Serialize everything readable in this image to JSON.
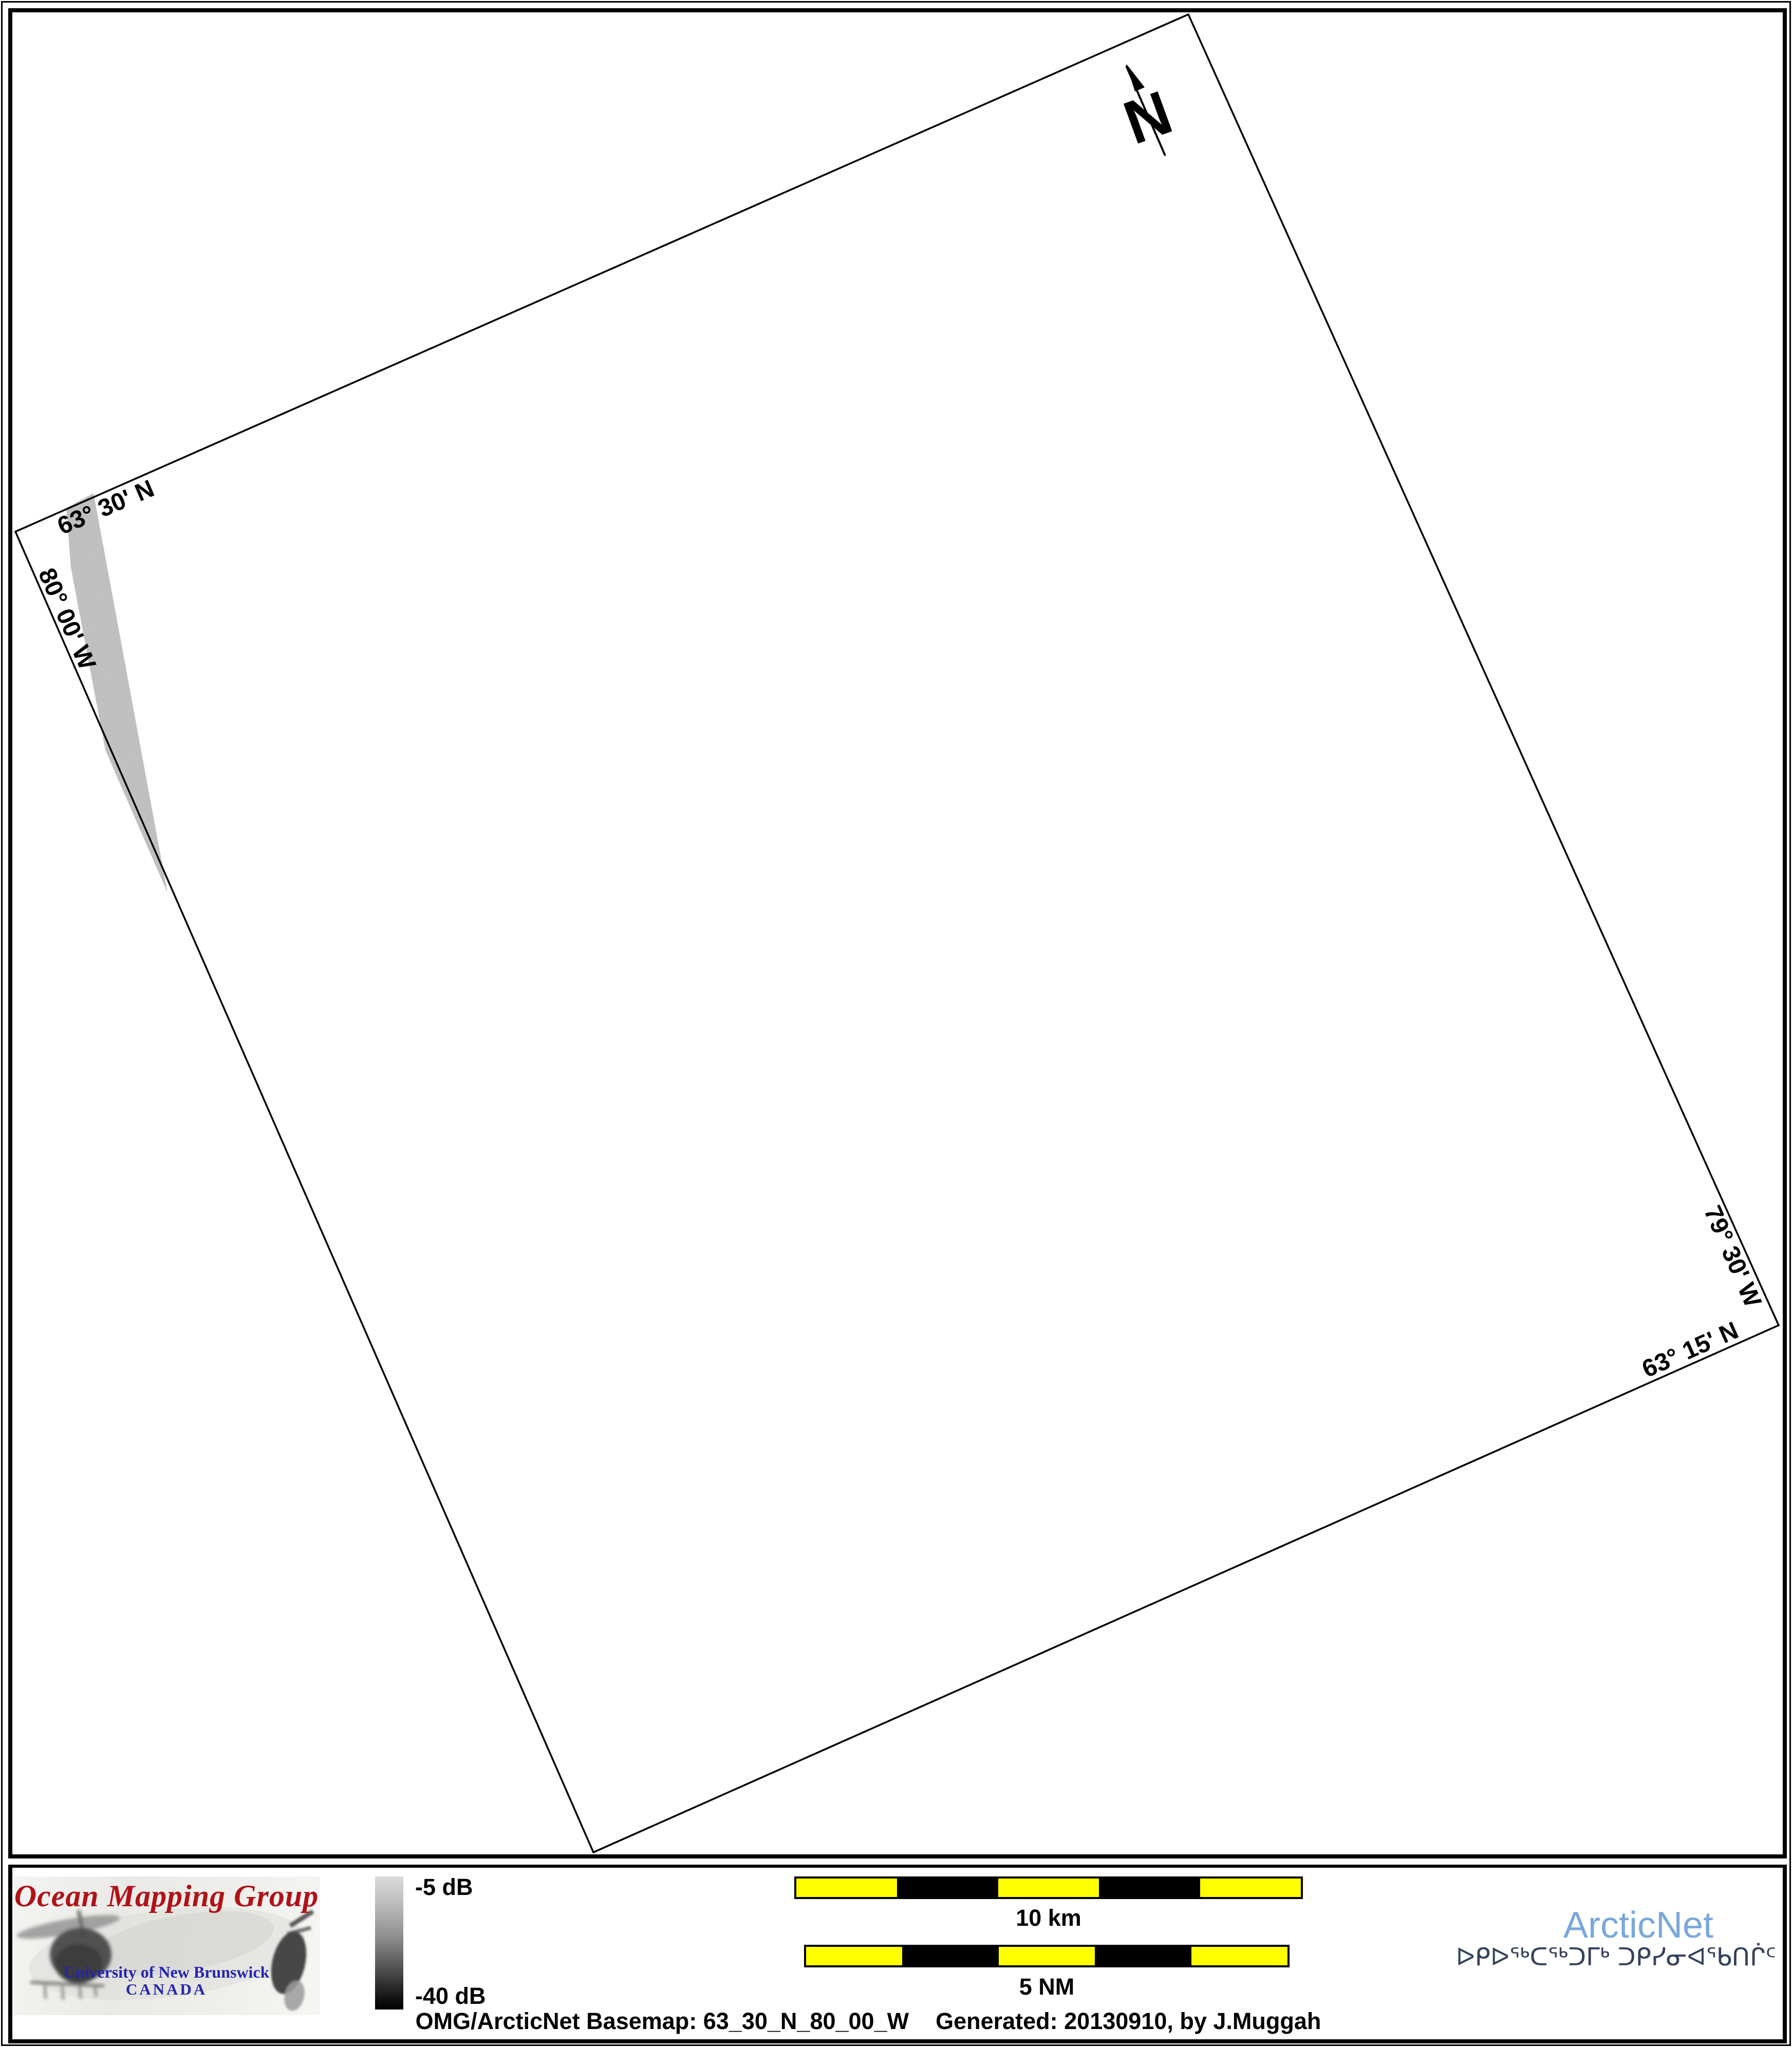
{
  "map": {
    "corner_labels": [
      {
        "text": "63° 30' N"
      },
      {
        "text": "80° 00' W"
      },
      {
        "text": "79° 30' W"
      },
      {
        "text": "63° 15' N"
      }
    ],
    "north_arrow_label": "N"
  },
  "legend": {
    "omg_logo": {
      "title": "Ocean Mapping Group",
      "institution": "University of New Brunswick",
      "country": "CANADA"
    },
    "colorbar": {
      "top_label": "-5 dB",
      "bottom_label": "-40 dB",
      "top_value_color": "#dadada",
      "bottom_value_color": "#000000"
    },
    "scale_bars": [
      {
        "label": "10 km",
        "segments": 5
      },
      {
        "label": "5 NM",
        "segments": 5
      }
    ],
    "arcticnet": {
      "wordmark": "ArcticNet",
      "inuktitut": "ᐅᑭᐅᖅᑕᖅᑐᒥᒃ ᑐᑭᓯᓂᐊᖃᑎᒌᑦ"
    },
    "caption": {
      "basemap": "OMG/ArcticNet Basemap: 63_30_N_80_00_W",
      "generated": "Generated: 20130910, by J.Muggah"
    }
  },
  "colors": {
    "scalebar_yellow": "#ffff00",
    "omg_red": "#b01218",
    "unb_blue": "#2525b0",
    "arcticnet_blue": "#7ba8da",
    "inuktitut_navy": "#34415a",
    "swath_gray": "#c2c2c2"
  }
}
